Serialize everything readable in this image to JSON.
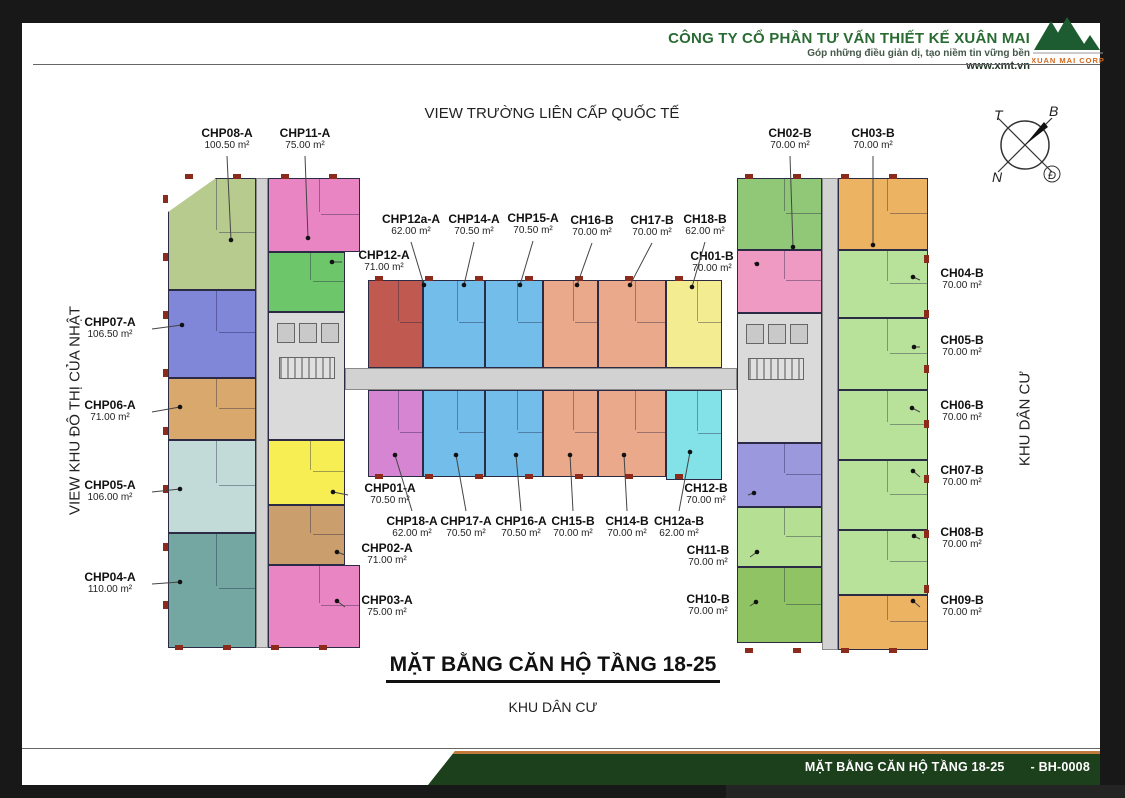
{
  "header": {
    "company": "CÔNG TY CỔ PHẦN TƯ VẤN THIẾT KẾ XUÂN MAI",
    "slogan": "Góp những điều giản dị, tạo niềm tin vững bền",
    "website": "www.xmt.vn",
    "logo_text": "XUAN MAI CORP"
  },
  "compass": {
    "top_left": "T",
    "top_right": "B",
    "bottom_left": "N",
    "bottom_right": "Đ"
  },
  "views": {
    "top": "VIEW TRƯỜNG LIÊN CẤP QUỐC TẾ",
    "left": "VIEW KHU ĐÔ THỊ CỦA NHẬT",
    "right": "KHU DÂN CƯ"
  },
  "titles": {
    "main": "MẶT BẰNG CĂN HỘ TẦNG 18-25",
    "subtitle": "KHU DÂN CƯ"
  },
  "footer": {
    "title": "MẶT BẰNG CĂN HỘ TẦNG 18-25",
    "code": "- BH-0008"
  },
  "colors": {
    "footer_green": "#1c3f1c",
    "footer_orange": "#c07a3c",
    "logo_green": "#1d5c30",
    "logo_orange": "#d2691e",
    "wall": "#2b2b45",
    "accent_red": "#8c2b1b",
    "corridor": "#d2d2d2"
  },
  "units": [
    {
      "id": "CHP08-A",
      "area": "100.50 m²",
      "color": "#b7cb8f",
      "rect": [
        168,
        178,
        88,
        112
      ],
      "label": [
        227,
        126
      ],
      "dot": [
        231,
        240
      ],
      "side": "down",
      "cut": "tl"
    },
    {
      "id": "CHP11-A",
      "area": "75.00 m²",
      "color": "#e985c3",
      "rect": [
        268,
        178,
        92,
        74
      ],
      "label": [
        305,
        126
      ],
      "dot": [
        308,
        238
      ],
      "side": "down"
    },
    {
      "id": "CHP07-A",
      "area": "106.50 m²",
      "color": "#8187d8",
      "rect": [
        168,
        290,
        88,
        88
      ],
      "label": [
        110,
        315
      ],
      "dot": [
        182,
        325
      ],
      "side": "right"
    },
    {
      "id": "CHP06-A",
      "area": "71.00 m²",
      "color": "#d8a86c",
      "rect": [
        168,
        378,
        88,
        62
      ],
      "label": [
        110,
        398
      ],
      "dot": [
        180,
        407
      ],
      "side": "right"
    },
    {
      "id": "CHP05-A",
      "area": "106.00 m²",
      "color": "#c2dbd9",
      "rect": [
        168,
        440,
        88,
        93
      ],
      "label": [
        110,
        478
      ],
      "dot": [
        180,
        489
      ],
      "side": "right"
    },
    {
      "id": "CHP04-A",
      "area": "110.00 m²",
      "color": "#74a7a2",
      "rect": [
        168,
        533,
        88,
        115
      ],
      "label": [
        110,
        570
      ],
      "dot": [
        180,
        582
      ],
      "side": "right"
    },
    {
      "id": "CHP12-A",
      "area": "71.00 m²",
      "color": "#6ec66b",
      "rect": [
        268,
        252,
        77,
        60
      ],
      "label": [
        384,
        248
      ],
      "dot": [
        332,
        262
      ],
      "side": "left"
    },
    {
      "id": "CHP01-A",
      "area": "70.50 m²",
      "color": "#f6ee52",
      "rect": [
        268,
        440,
        77,
        65
      ],
      "label": [
        390,
        481
      ],
      "dot": [
        333,
        492
      ],
      "side": "left"
    },
    {
      "id": "CHP02-A",
      "area": "71.00 m²",
      "color": "#cb9e6e",
      "rect": [
        268,
        505,
        77,
        60
      ],
      "label": [
        387,
        541
      ],
      "dot": [
        337,
        552
      ],
      "side": "left"
    },
    {
      "id": "CHP03-A",
      "area": "75.00 m²",
      "color": "#e985c3",
      "rect": [
        268,
        565,
        92,
        83
      ],
      "label": [
        387,
        593
      ],
      "dot": [
        337,
        601
      ],
      "side": "left"
    },
    {
      "id": "CHP12a-A",
      "area": "62.00 m²",
      "color": "#c05a50",
      "rect": [
        368,
        280,
        55,
        88
      ],
      "label": [
        411,
        212
      ],
      "dot": [
        424,
        285
      ],
      "side": "down"
    },
    {
      "id": "CHP14-A",
      "area": "70.50 m²",
      "color": "#72bde9",
      "rect": [
        423,
        280,
        62,
        88
      ],
      "label": [
        474,
        212
      ],
      "dot": [
        464,
        285
      ],
      "side": "down"
    },
    {
      "id": "CHP15-A",
      "area": "70.50 m²",
      "color": "#72bde9",
      "rect": [
        485,
        280,
        58,
        88
      ],
      "label": [
        533,
        211
      ],
      "dot": [
        520,
        285
      ],
      "side": "down"
    },
    {
      "id": "CH16-B",
      "area": "70.00 m²",
      "color": "#eaa98b",
      "rect": [
        543,
        280,
        55,
        88
      ],
      "label": [
        592,
        213
      ],
      "dot": [
        577,
        285
      ],
      "side": "down"
    },
    {
      "id": "CH17-B",
      "area": "70.00 m²",
      "color": "#eaa98b",
      "rect": [
        598,
        280,
        68,
        88
      ],
      "label": [
        652,
        213
      ],
      "dot": [
        630,
        285
      ],
      "side": "down"
    },
    {
      "id": "CH18-B",
      "area": "62.00 m²",
      "color": "#f4ec90",
      "rect": [
        666,
        280,
        56,
        88
      ],
      "label": [
        705,
        212
      ],
      "dot": [
        692,
        287
      ],
      "side": "down"
    },
    {
      "id": "CH01-B",
      "area": "70.00 m²",
      "color": "#ef9ac2",
      "rect": [
        737,
        250,
        85,
        63
      ],
      "label": [
        712,
        249
      ],
      "dot": [
        757,
        264
      ],
      "side": "right"
    },
    {
      "id": "CHP18-A",
      "area": "62.00 m²",
      "color": "#d685d3",
      "rect": [
        368,
        390,
        55,
        87
      ],
      "label": [
        412,
        514
      ],
      "dot": [
        395,
        455
      ],
      "side": "up"
    },
    {
      "id": "CHP17-A",
      "area": "70.50 m²",
      "color": "#72bde9",
      "rect": [
        423,
        390,
        62,
        87
      ],
      "label": [
        466,
        514
      ],
      "dot": [
        456,
        455
      ],
      "side": "up"
    },
    {
      "id": "CHP16-A",
      "area": "70.50 m²",
      "color": "#72bde9",
      "rect": [
        485,
        390,
        58,
        87
      ],
      "label": [
        521,
        514
      ],
      "dot": [
        516,
        455
      ],
      "side": "up"
    },
    {
      "id": "CH15-B",
      "area": "70.00 m²",
      "color": "#eaa98b",
      "rect": [
        543,
        390,
        55,
        87
      ],
      "label": [
        573,
        514
      ],
      "dot": [
        570,
        455
      ],
      "side": "up"
    },
    {
      "id": "CH14-B",
      "area": "70.00 m²",
      "color": "#eaa98b",
      "rect": [
        598,
        390,
        68,
        87
      ],
      "label": [
        627,
        514
      ],
      "dot": [
        624,
        455
      ],
      "side": "up"
    },
    {
      "id": "CH12a-B",
      "area": "62.00 m²",
      "color": "#83e1e8",
      "rect": [
        666,
        390,
        56,
        90
      ],
      "label": [
        679,
        514
      ],
      "dot": [
        690,
        452
      ],
      "side": "up"
    },
    {
      "id": "CH12-B",
      "area": "70.00 m²",
      "color": "#9b98de",
      "rect": [
        737,
        443,
        85,
        64
      ],
      "label": [
        706,
        481
      ],
      "dot": [
        754,
        493
      ],
      "side": "right"
    },
    {
      "id": "CH11-B",
      "area": "70.00 m²",
      "color": "#b5df92",
      "rect": [
        737,
        507,
        85,
        60
      ],
      "label": [
        708,
        543
      ],
      "dot": [
        757,
        552
      ],
      "side": "right"
    },
    {
      "id": "CH10-B",
      "area": "70.00 m²",
      "color": "#8fc363",
      "rect": [
        737,
        567,
        85,
        76
      ],
      "label": [
        708,
        592
      ],
      "dot": [
        756,
        602
      ],
      "side": "right"
    },
    {
      "id": "CH02-B",
      "area": "70.00 m²",
      "color": "#90c878",
      "rect": [
        737,
        178,
        85,
        72
      ],
      "label": [
        790,
        126
      ],
      "dot": [
        793,
        247
      ],
      "side": "down"
    },
    {
      "id": "CH03-B",
      "area": "70.00 m²",
      "color": "#ecb363",
      "rect": [
        838,
        178,
        90,
        72
      ],
      "label": [
        873,
        126
      ],
      "dot": [
        873,
        245
      ],
      "side": "down"
    },
    {
      "id": "CH04-B",
      "area": "70.00 m²",
      "color": "#b8e19a",
      "rect": [
        838,
        250,
        90,
        68
      ],
      "label": [
        962,
        266
      ],
      "dot": [
        913,
        277
      ],
      "side": "left"
    },
    {
      "id": "CH05-B",
      "area": "70.00 m²",
      "color": "#b8e19a",
      "rect": [
        838,
        318,
        90,
        72
      ],
      "label": [
        962,
        333
      ],
      "dot": [
        914,
        347
      ],
      "side": "left"
    },
    {
      "id": "CH06-B",
      "area": "70.00 m²",
      "color": "#b8e19a",
      "rect": [
        838,
        390,
        90,
        70
      ],
      "label": [
        962,
        398
      ],
      "dot": [
        912,
        408
      ],
      "side": "left"
    },
    {
      "id": "CH07-B",
      "area": "70.00 m²",
      "color": "#b8e19a",
      "rect": [
        838,
        460,
        90,
        70
      ],
      "label": [
        962,
        463
      ],
      "dot": [
        913,
        471
      ],
      "side": "left"
    },
    {
      "id": "CH08-B",
      "area": "70.00 m²",
      "color": "#b8e19a",
      "rect": [
        838,
        530,
        90,
        65
      ],
      "label": [
        962,
        525
      ],
      "dot": [
        914,
        536
      ],
      "side": "left"
    },
    {
      "id": "CH09-B",
      "area": "70.00 m²",
      "color": "#ecb363",
      "rect": [
        838,
        595,
        90,
        55
      ],
      "label": [
        962,
        593
      ],
      "dot": [
        913,
        601
      ],
      "side": "left"
    }
  ],
  "cores": [
    {
      "rect": [
        268,
        312,
        77,
        128
      ]
    },
    {
      "rect": [
        737,
        313,
        85,
        130
      ]
    }
  ],
  "corridors": [
    [
      256,
      178,
      12,
      470
    ],
    [
      822,
      178,
      16,
      472
    ],
    [
      345,
      368,
      392,
      22
    ]
  ]
}
